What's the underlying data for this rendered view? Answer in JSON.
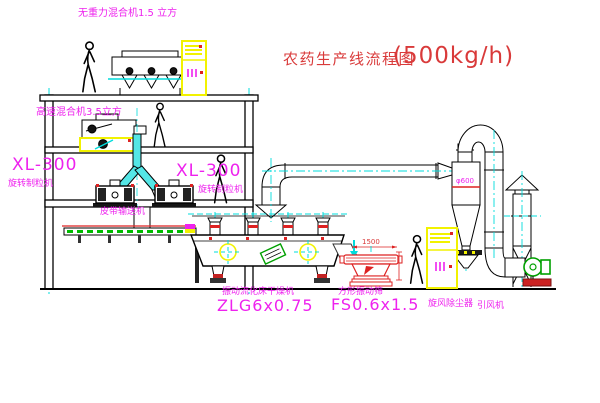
{
  "title": {
    "main": "农药生产线流程图",
    "capacity": "(500kg/h)"
  },
  "labels": {
    "gravity_mixer": "无重力混合机1.5 立方",
    "high_speed_mixer": "高速混合机3.5立方",
    "granulator_model_left": "XL-300",
    "granulator_name_left": "旋转制粒机",
    "granulator_model_right": "XL-300",
    "granulator_name_right": "旋转制粒机",
    "belt_conveyor": "皮带输送机",
    "dryer_name": "振动流化床干燥机",
    "dryer_model": "ZLG6x0.75",
    "sieve_name": "方形振动筛",
    "sieve_model": "FS0.6x1.5",
    "sieve_dimension": "1500",
    "cyclone_name": "旋风除尘器",
    "cyclone_dimension": "φ600",
    "fan_name": "引风机"
  },
  "colors": {
    "label_magenta": "#ee22ee",
    "title_red": "#d93a3a",
    "centerline_cyan": "#00dcdc",
    "cabinet_yellow": "#f2f200",
    "pipe_fill_cyan": "#54e6e6",
    "alert_red": "#dd2222",
    "fan_green": "#00a000"
  }
}
